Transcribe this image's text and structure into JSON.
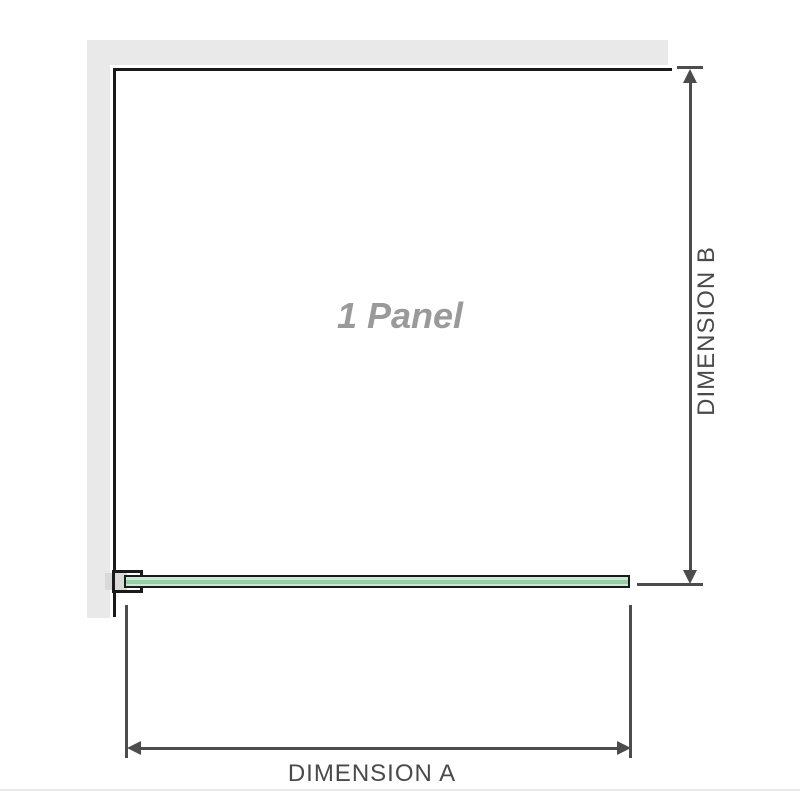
{
  "diagram": {
    "title": "1 Panel",
    "dimension_a": {
      "label": "DIMENSION A"
    },
    "dimension_b": {
      "label": "DIMENSION B"
    }
  },
  "icons": {
    "dimension_b_arrow_up": "triangle-up",
    "dimension_b_arrow_down": "triangle-down",
    "dimension_a_arrow_left": "triangle-left",
    "dimension_a_arrow_right": "triangle-right"
  },
  "colors": {
    "background": "#ffffff",
    "wall": "#e9e9e9",
    "panel_edge": "#1a1a1a",
    "dimension": "#4c4c4c",
    "glass_fill": "#cde9d4",
    "glass_core": "#96cfa6",
    "bracket_filler": "#d9d9d9",
    "title_text": "#9a9a9a",
    "label_text": "#4a4a4a",
    "divider": "#ebe8e5"
  }
}
